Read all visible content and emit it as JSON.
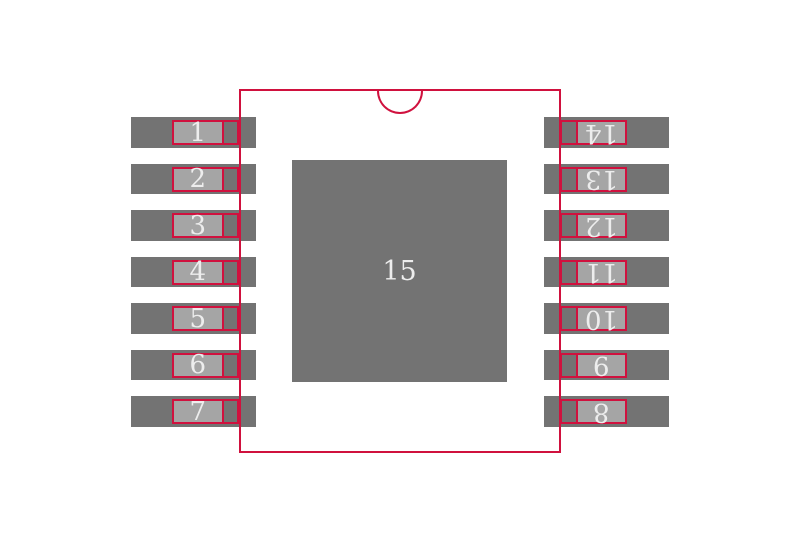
{
  "colors": {
    "background": "#ffffff",
    "copper_pad": "#737373",
    "pin_fill": "#a5a5a5",
    "outline_red": "#d0113e",
    "number_text": "#ededed"
  },
  "exposed_pad": {
    "number": "15"
  },
  "pads": {
    "left": [
      "1",
      "2",
      "3",
      "4",
      "5",
      "6",
      "7"
    ],
    "right": [
      "14",
      "13",
      "12",
      "11",
      "10",
      "9",
      "8"
    ]
  }
}
